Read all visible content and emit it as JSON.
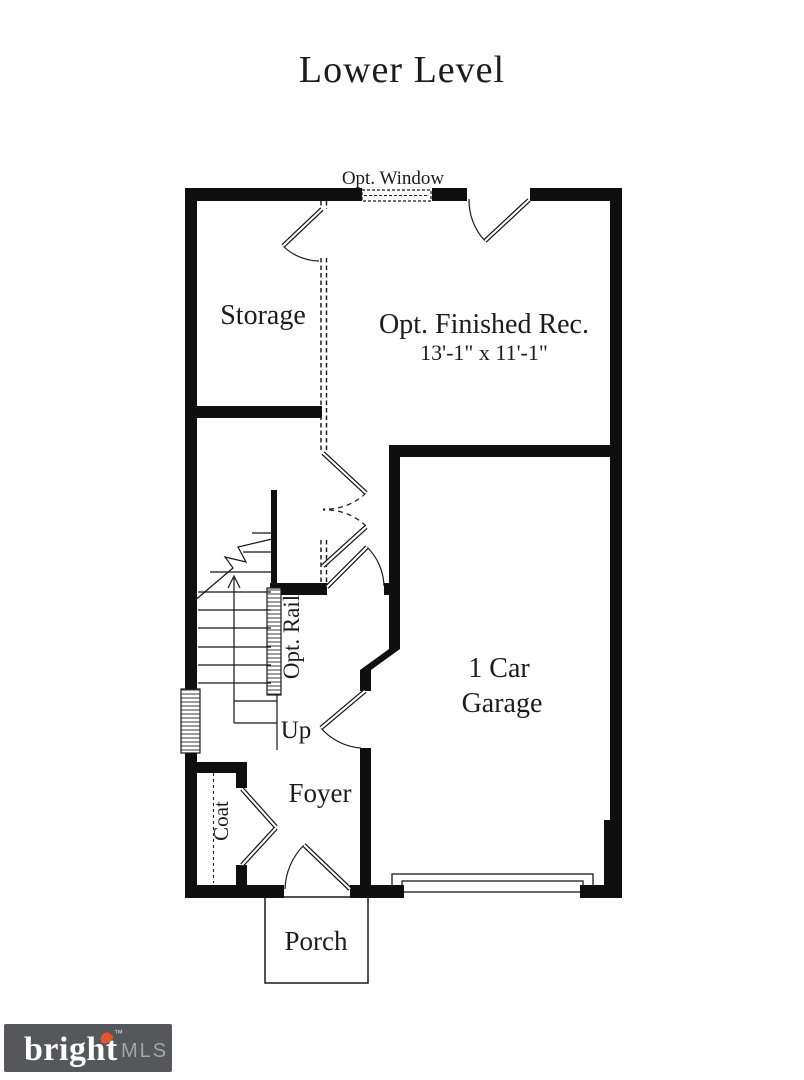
{
  "header": {
    "title": "Lower Level"
  },
  "plan": {
    "labels": {
      "opt_window": "Opt. Window",
      "storage": "Storage",
      "rec_title": "Opt. Finished Rec.",
      "rec_dims": "13'-1\" x 11'-1\"",
      "opt_rail": "Opt. Rail",
      "up": "Up",
      "garage1": "1 Car",
      "garage2": "Garage",
      "foyer": "Foyer",
      "coat": "Coat",
      "porch": "Porch"
    }
  },
  "logo": {
    "brand": "bright",
    "tm": "™",
    "mls": "MLS"
  },
  "colors": {
    "line": "#111111",
    "background": "#fefefe",
    "logo_bg": "#56575a",
    "logo_brand": "#ffffff",
    "logo_mls": "#a3a4a7",
    "flame": "#e8542a"
  }
}
